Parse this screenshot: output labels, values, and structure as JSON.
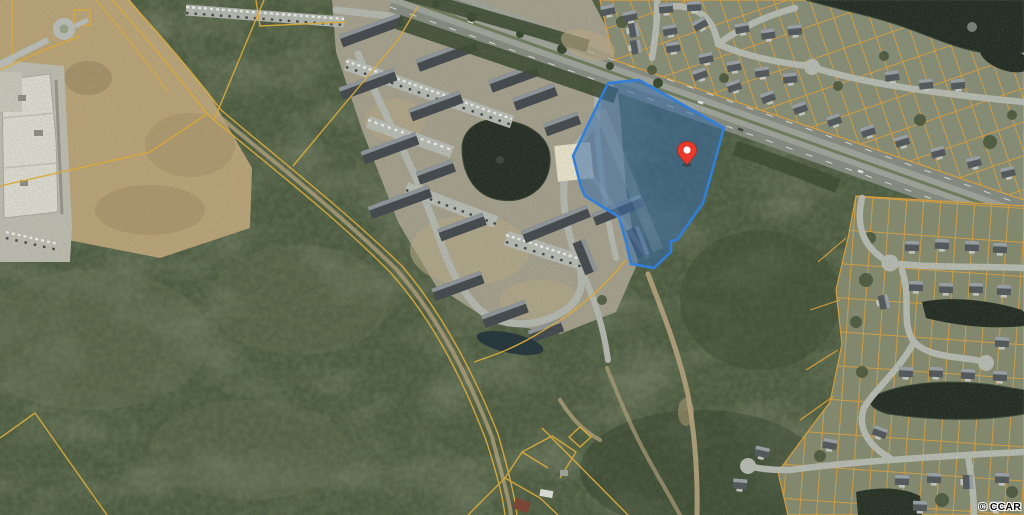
{
  "image": {
    "type": "aerial-parcel-map",
    "width": 1024,
    "height": 515
  },
  "watermark": {
    "text": "© CCAR"
  },
  "marker": {
    "name": "red-location-pin",
    "color": "#e8392b",
    "border": "#a82418",
    "dot_color": "#ffffff"
  },
  "parcel": {
    "name": "highlighted-listing-parcel",
    "fill": "rgba(56,108,166,0.55)",
    "stroke": "#2f7fdb"
  },
  "palette": {
    "lot_line": "#e0a03c",
    "boundary_line": "#d8a93c",
    "forest": "#4b5840",
    "field": "#b9a278",
    "street": "#b5b8b2",
    "highway": "#868a81",
    "water": "#232b24",
    "dirt_path": "#b3a17c"
  },
  "features": [
    "forest",
    "vacant-field",
    "commercial-building",
    "apartment-complex",
    "divided-highway",
    "residential-neighborhood-north",
    "residential-neighborhood-east",
    "ponds",
    "dirt-paths",
    "parcel-boundary-lines",
    "highlighted-parcel",
    "location-pin"
  ]
}
